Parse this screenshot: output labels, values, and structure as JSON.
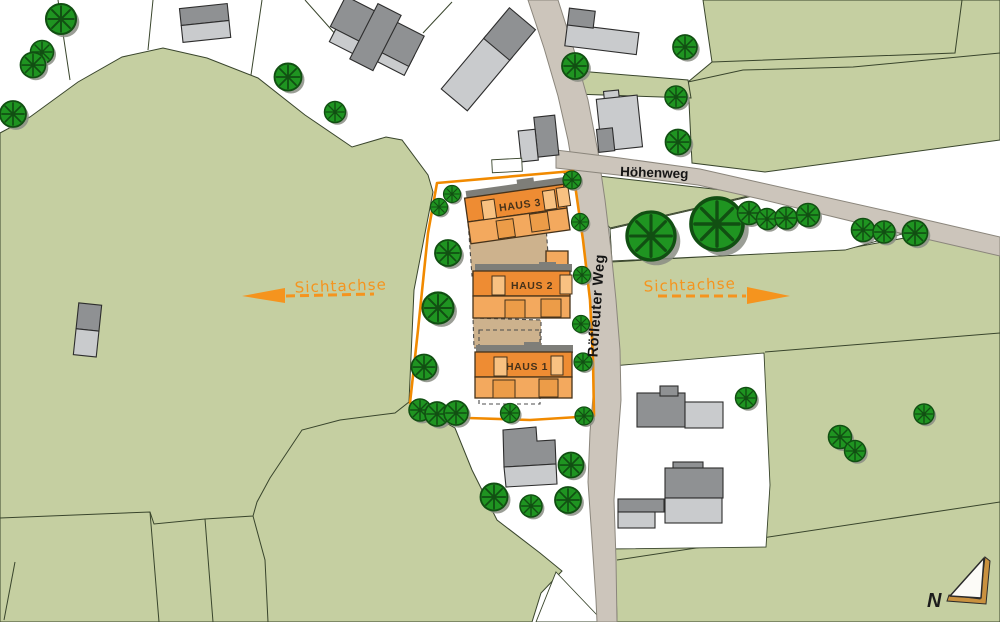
{
  "labels": {
    "haus_3": "HAUS 3",
    "haus_2": "HAUS 2",
    "haus_1": "HAUS 1",
    "sichtachse_west": "Sichtachse",
    "sichtachse_east": "Sichtachse",
    "street_main": "Röfleuter Weg",
    "street_side": "Höhenweg",
    "north_letter": "N"
  },
  "colors": {
    "meadow": "#c5cfa1",
    "meadow_line": "#39452c",
    "road": "#ccc5bb",
    "road_edge": "#8b867c",
    "plot_boundary": "#f18a00",
    "haus_dark": "#ee8c33",
    "haus_light": "#f3a95e",
    "haus_win": "#f8c181",
    "haus_win2": "#ec9c48",
    "haus_outline": "#46321a",
    "terrace": "#cdb28d",
    "bld_dark": "#8f9193",
    "bld_light": "#c9cbcd",
    "bld_outline": "#2d2d2d",
    "tree_fill": "#1f9421",
    "tree_dark": "#114f12",
    "tree_shadow": "#8a8d84",
    "shadow_gray": "#7e7e79",
    "sicht": "#f5941e",
    "north_band": "#c9913f"
  }
}
